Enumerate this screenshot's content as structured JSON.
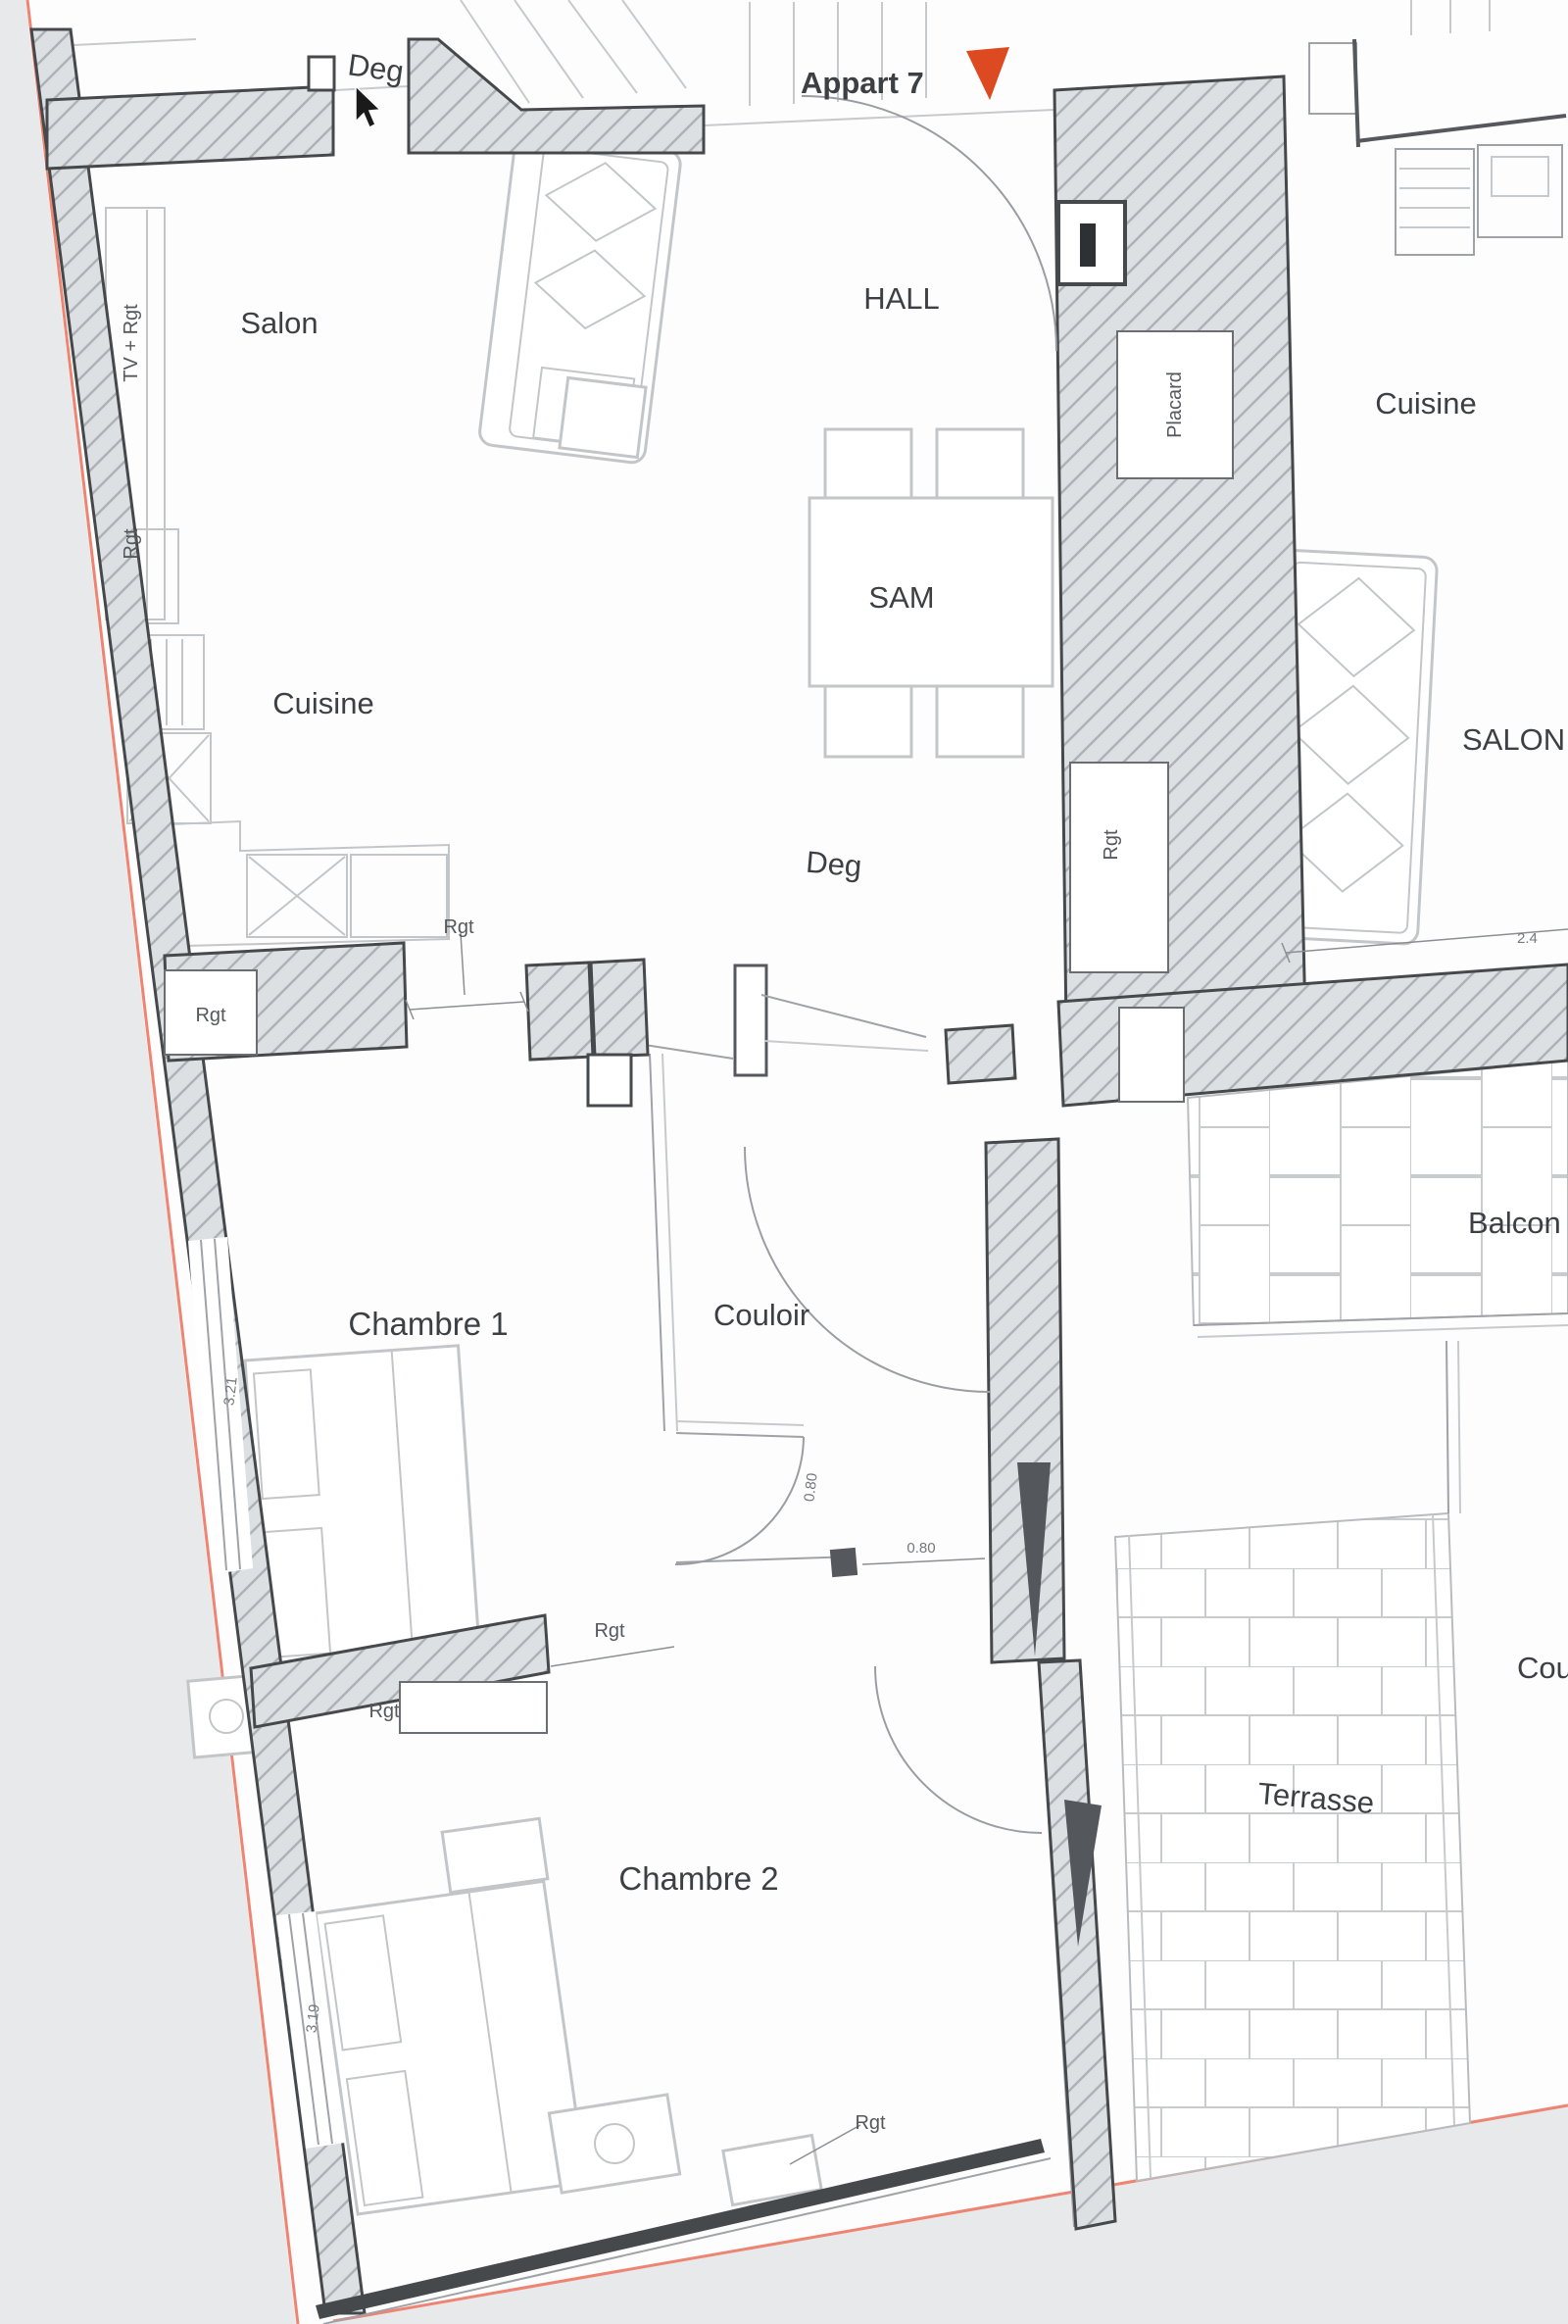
{
  "marker": {
    "label": "Appart 7",
    "color": "#ce3f24",
    "triangle_icon": "red-down-triangle"
  },
  "rooms": {
    "deg_top": "Deg",
    "salon": "Salon",
    "hall": "HALL",
    "cuisine_right": "Cuisine",
    "sam": "SAM",
    "cuisine_left": "Cuisine",
    "deg_center": "Deg",
    "salon_right": "SALON",
    "balcon": "Balcon",
    "couloir": "Couloir",
    "chambre1": "Chambre 1",
    "chambre2": "Chambre 2",
    "terrasse": "Terrasse",
    "cour": "Cour",
    "placard": "Placard"
  },
  "annotations": {
    "rgt": "Rgt",
    "tv_rgt": "TV + Rgt"
  },
  "dims": {
    "d080": "0.80",
    "d321": "3.21",
    "d319": "3.19",
    "d24": "2.4"
  },
  "colors": {
    "outside_gray": "#e8e9ea",
    "boundary_red": "#ee8472",
    "wall_outline": "#46494c",
    "wall_fill": "#dde0e3",
    "hatch_line": "#aeb1b5",
    "marker_red": "#ce3f24"
  }
}
